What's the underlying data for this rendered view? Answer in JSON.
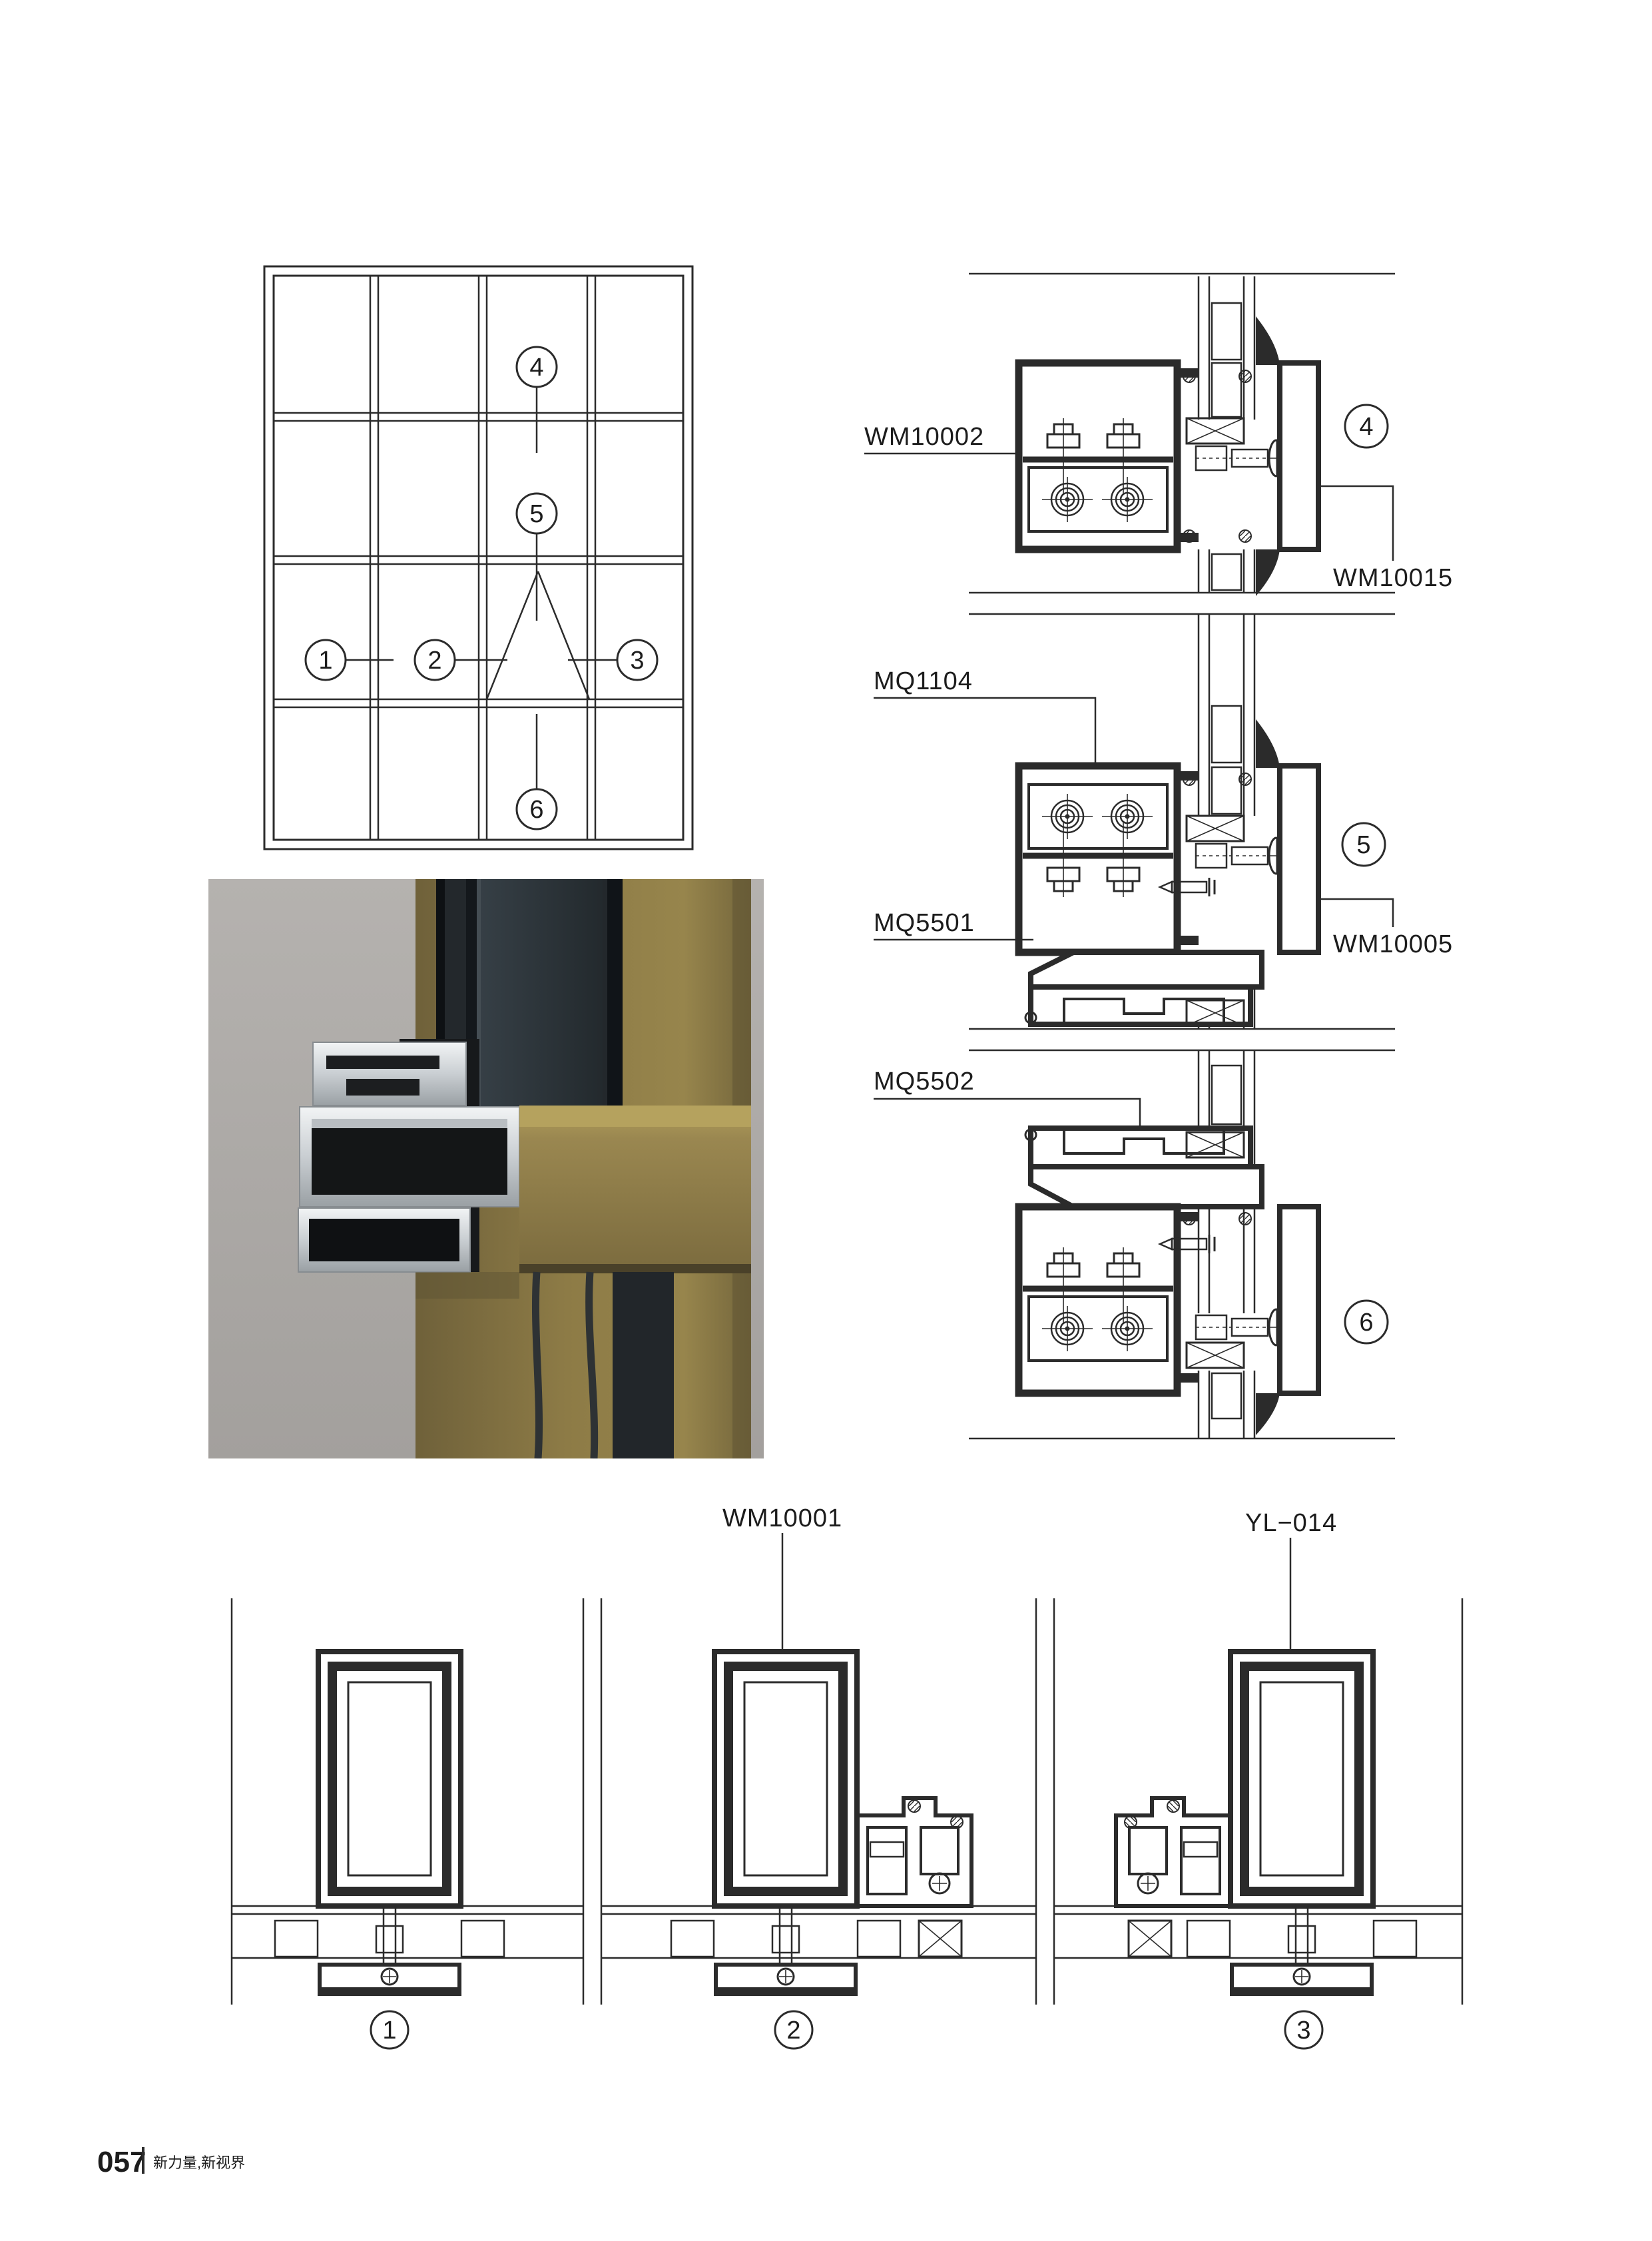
{
  "footer": {
    "page_number": "057",
    "tagline": "新力量,新视界"
  },
  "callouts": {
    "c1": "1",
    "c2": "2",
    "c3": "3",
    "c4": "4",
    "c5": "5",
    "c6": "6"
  },
  "section_labels": {
    "wm10002": "WM10002",
    "wm10015": "WM10015",
    "mq1104": "MQ1104",
    "mq5501": "MQ5501",
    "wm10005": "WM10005",
    "mq5502": "MQ5502",
    "wm10001": "WM10001",
    "yl014": "YL−014"
  },
  "colors": {
    "line": "#2b2b2b",
    "render_background_gray": "#aba8a5",
    "render_gold": "#8d7b46",
    "render_dark_glass": "#23282c",
    "render_aluminum": "#ccd1d5"
  }
}
